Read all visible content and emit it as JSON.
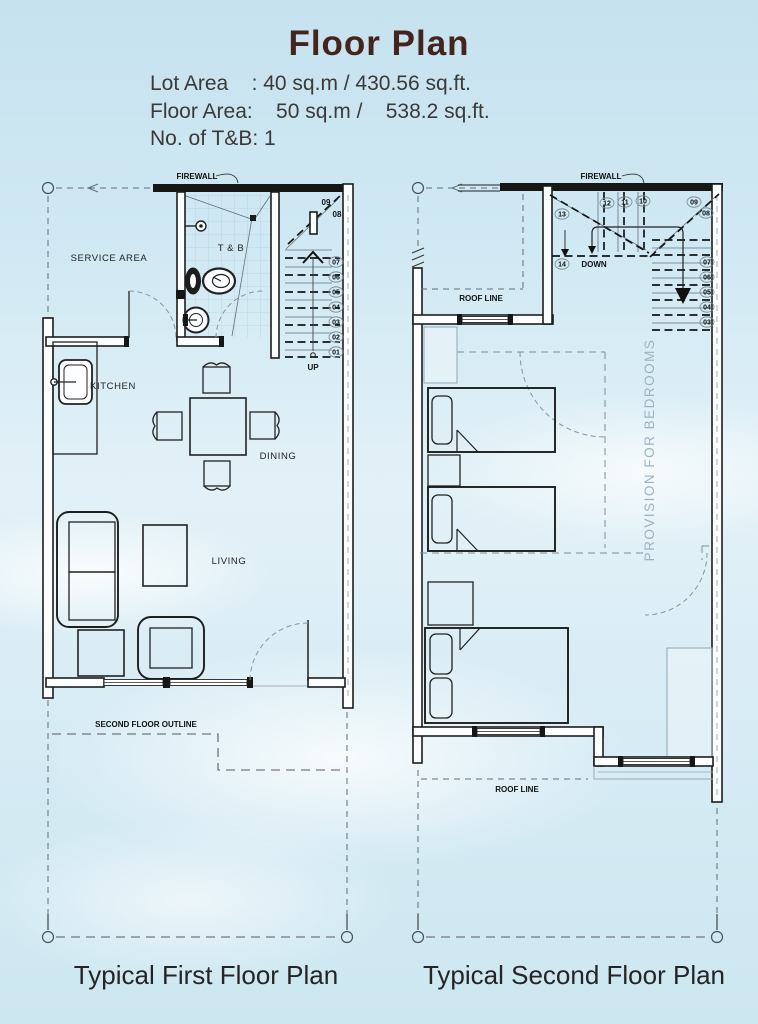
{
  "header": {
    "title": "Floor Plan",
    "specs_lines": "Lot Area    : 40 sq.m / 430.56 sq.ft.\nFloor Area:    50 sq.m /    538.2 sq.ft.\nNo. of T&B: 1"
  },
  "first_floor": {
    "caption": "Typical First Floor Plan",
    "labels": {
      "firewall": "FIREWALL",
      "service_area": "SERVICE AREA",
      "toilet_bath": "T & B",
      "kitchen": "KITCHEN",
      "dining": "DINING",
      "living": "LIVING",
      "up": "UP",
      "second_floor_outline": "SECOND FLOOR OUTLINE"
    },
    "stair_numbers": [
      "01",
      "02",
      "03",
      "04",
      "05",
      "06",
      "07",
      "08",
      "09"
    ]
  },
  "second_floor": {
    "caption": "Typical Second Floor Plan",
    "labels": {
      "firewall": "FIREWALL",
      "roof_line_upper": "ROOF LINE",
      "roof_line_lower": "ROOF LINE",
      "down": "DOWN",
      "provision": "PROVISION FOR BEDROOMS"
    },
    "stair_numbers": [
      "03",
      "04",
      "05",
      "06",
      "07",
      "08",
      "09",
      "10",
      "11",
      "12",
      "13",
      "14"
    ]
  },
  "colors": {
    "title": "#46241e",
    "body_text": "#3b3a39",
    "plan_line": "#1d1d1d",
    "sky": "#cfe8f3",
    "tile": "#b5d2de"
  }
}
